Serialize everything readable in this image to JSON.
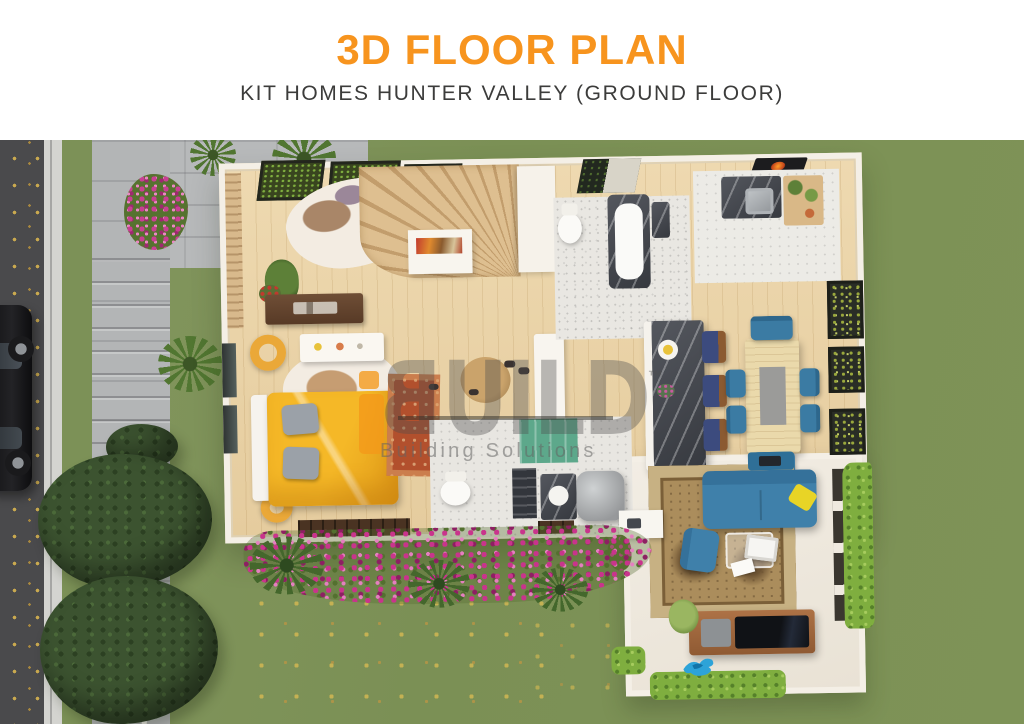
{
  "header": {
    "title": "3D FLOOR PLAN",
    "subtitle": "KIT HOMES HUNTER VALLEY (GROUND FLOOR)",
    "title_color": "#F7941E",
    "subtitle_color": "#3C3C3B"
  },
  "watermark": {
    "letters": [
      "B",
      "U",
      "I",
      "L",
      "D"
    ],
    "first_letter_mirrored": true,
    "prefix_i_color": "#F39A1C",
    "trademark": "™",
    "tagline": "Building Solutions"
  },
  "palette": {
    "grass": "#7C9157",
    "road_asphalt": "#4A4A4C",
    "concrete_path": "#B5B7B8",
    "house_wall": "#F4EFE6",
    "wood_floor": "#E9D2A7",
    "bed_yellow": "#F5B827",
    "sofa_blue": "#3F80AA",
    "stool_navy": "#3C4B7E",
    "island_marble": "#46494F",
    "dining_wood": "#EAD9AB",
    "living_rug": "#AB8D5C",
    "bedroom_rug_red": "#B2502D",
    "flowers_pink": "#C9348C",
    "bush_dark_green": "#3C5330",
    "hedge_bright_green": "#7FAE3F",
    "tv_console_wood": "#A4693F",
    "cabinet_green": "#5DA88B",
    "tank_gray": "#9A9C9E"
  }
}
